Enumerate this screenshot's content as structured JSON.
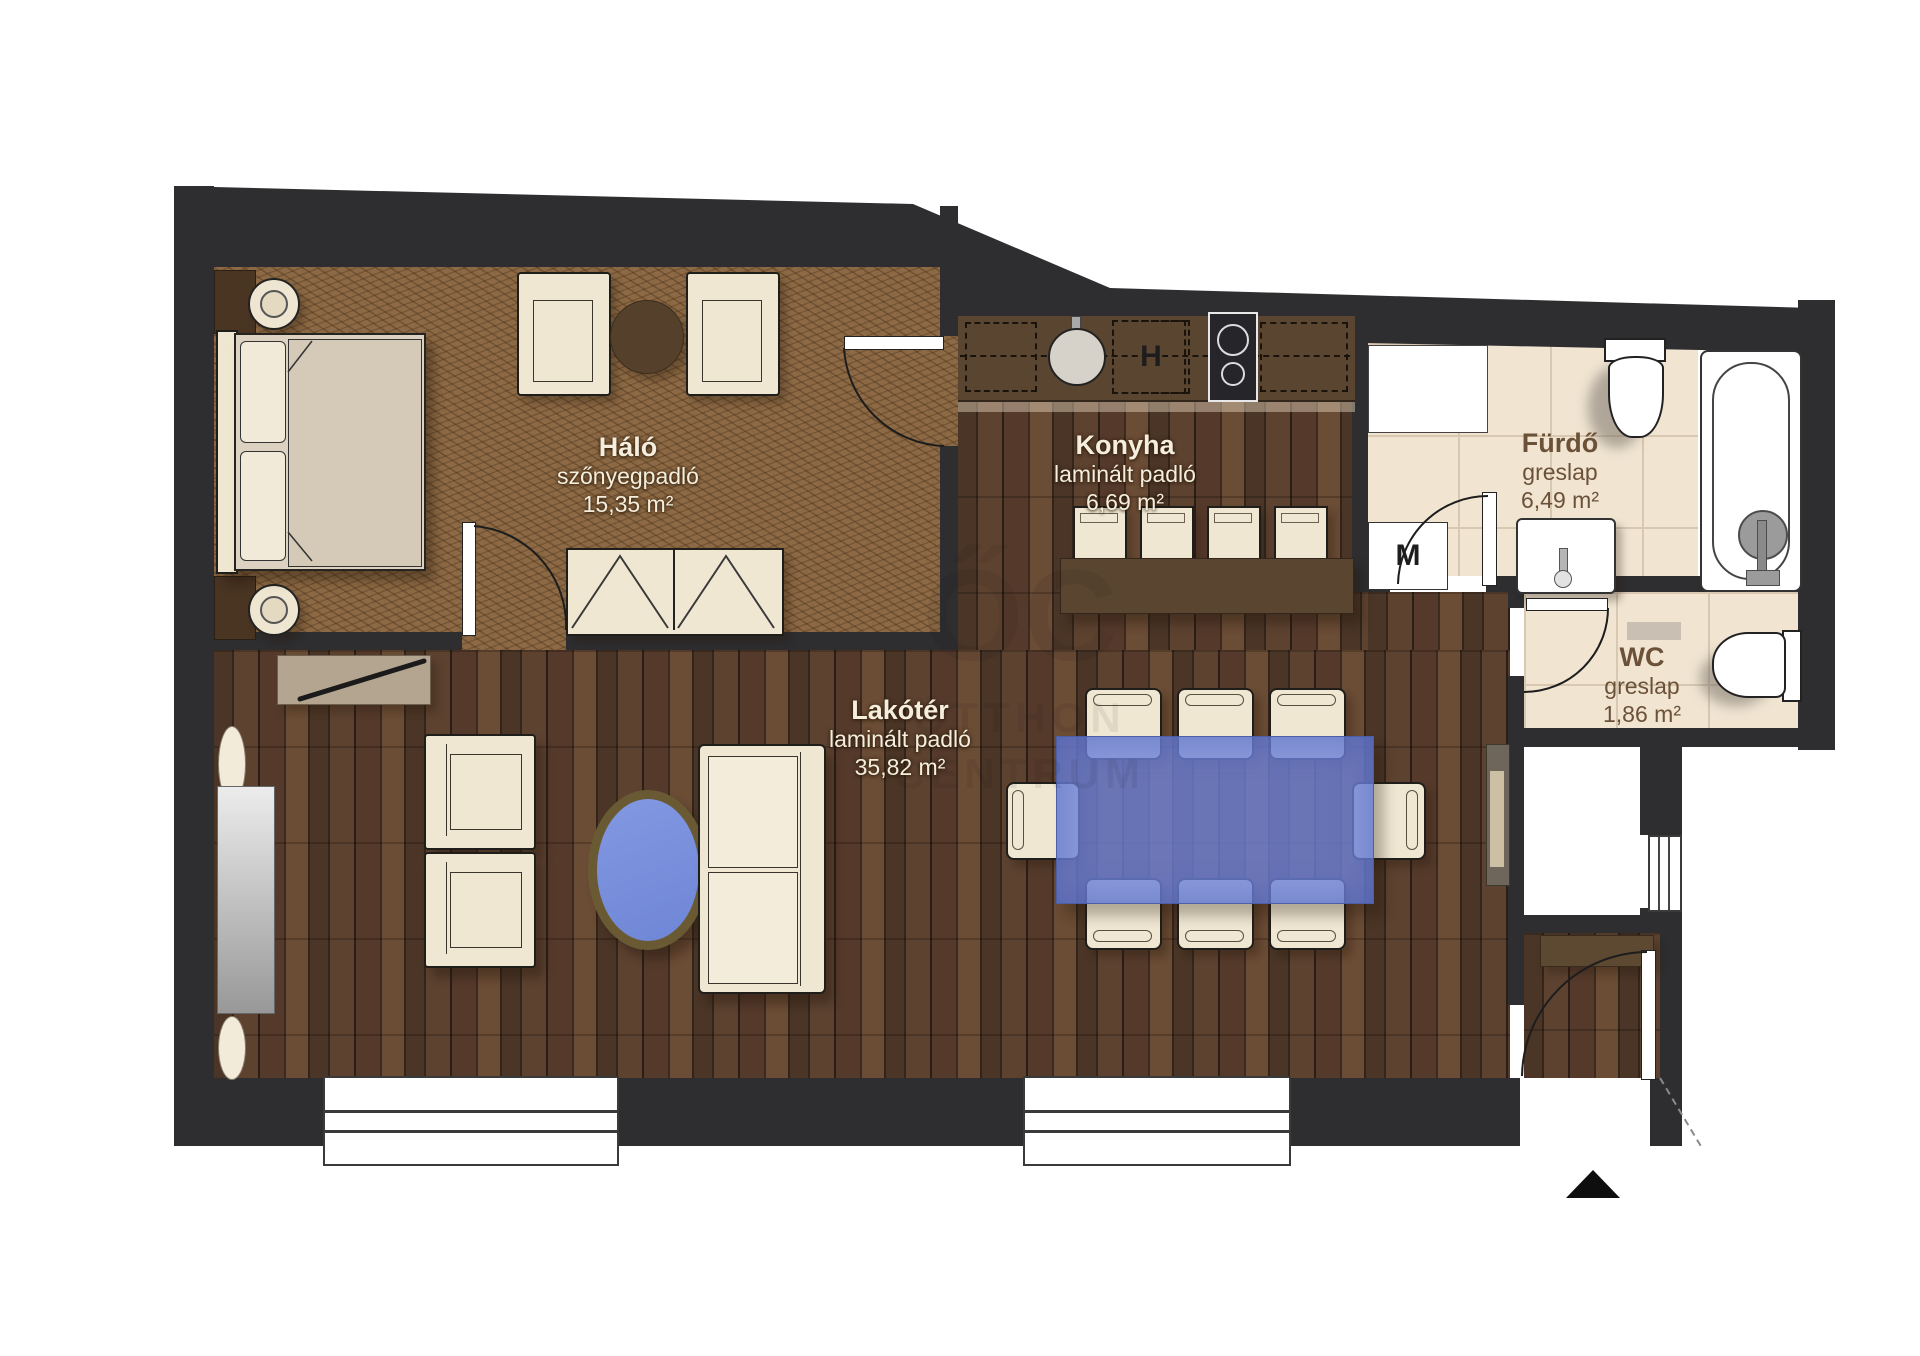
{
  "rooms": {
    "halo": {
      "name": "Háló",
      "floor": "szőnyegpadló",
      "area": "15,35 m²"
    },
    "konyha": {
      "name": "Konyha",
      "floor": "laminált padló",
      "area": "6,69 m²"
    },
    "furdo": {
      "name": "Fürdő",
      "floor": "greslap",
      "area": "6,49 m²"
    },
    "wc": {
      "name": "WC",
      "floor": "greslap",
      "area": "1,86 m²"
    },
    "lakoter": {
      "name": "Lakótér",
      "floor": "laminált padló",
      "area": "35,82 m²"
    }
  },
  "appliances": {
    "fridge_label": "H",
    "washing_machine_label": "M"
  },
  "watermark": {
    "logo": "ŐC",
    "line1": "OTTHON",
    "line2": "CENTRUM"
  },
  "colors": {
    "wall": "#2e2e30",
    "carpet": "#8d6a45",
    "wood_base": "#3d2c21",
    "tile": "#f1e5d2",
    "counter": "#5a4530",
    "furniture_cream": "#f0e7d3",
    "dining_table_blue": "#6e84dc",
    "coffee_table_rim": "#6a5a34"
  }
}
